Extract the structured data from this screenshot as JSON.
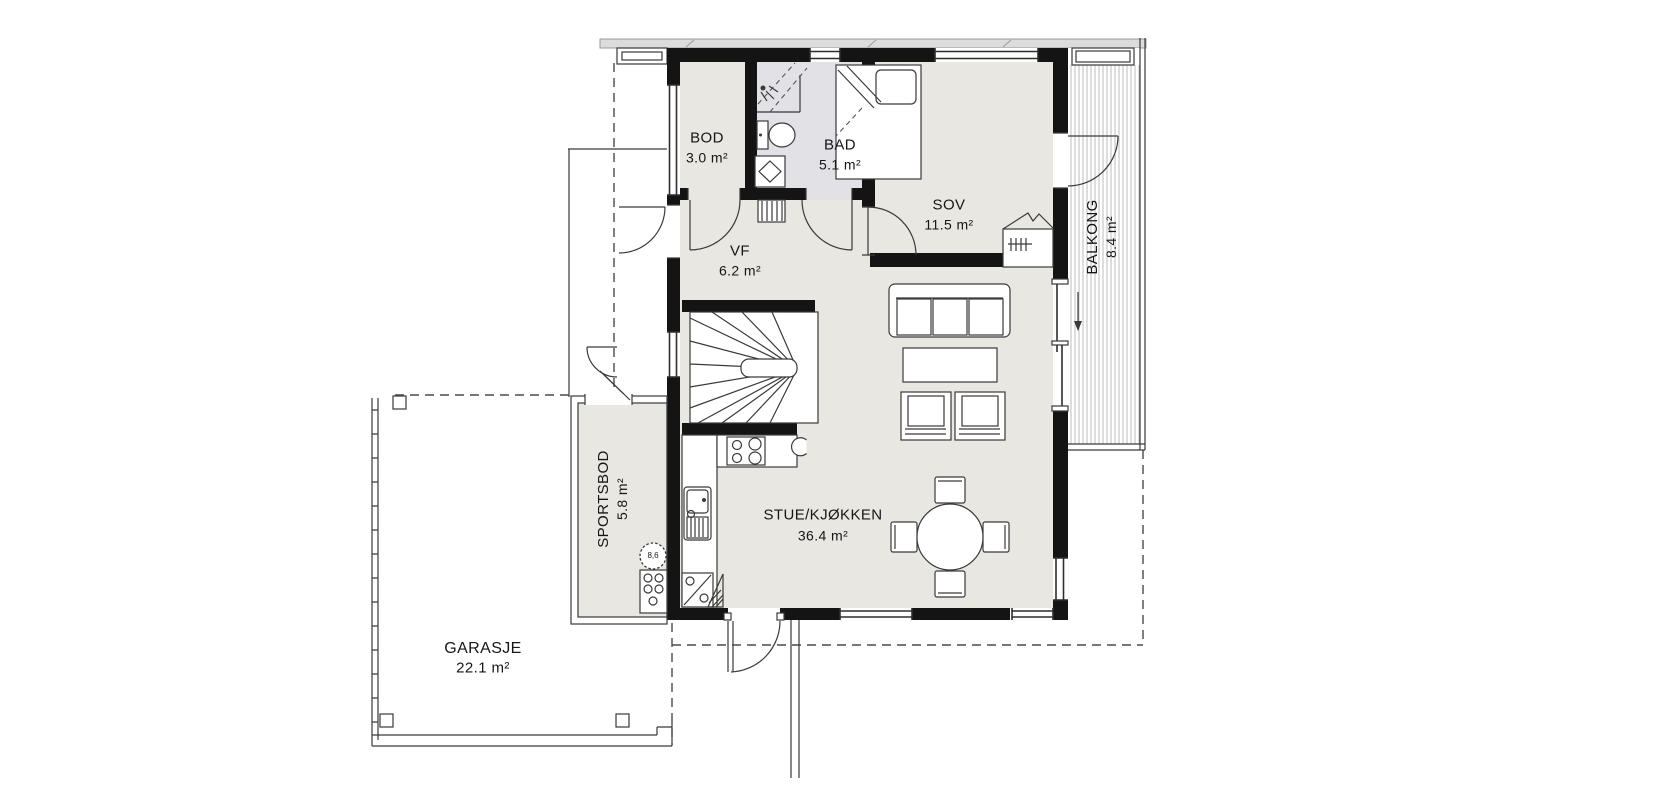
{
  "colors": {
    "wall": "#141414",
    "floor": "#e9e7e1",
    "bad_floor": "#e2e2e6",
    "line": "#3a3a3a",
    "hatch": "#bdbdbd",
    "text": "#161616"
  },
  "rooms": {
    "bod": {
      "name": "BOD",
      "area": "3.0 m²"
    },
    "bad": {
      "name": "BAD",
      "area": "5.1 m²"
    },
    "sov": {
      "name": "SOV",
      "area": "11.5 m²"
    },
    "vf": {
      "name": "VF",
      "area": "6.2 m²"
    },
    "stue": {
      "name": "STUE/KJØKKEN",
      "area": "36.4 m²"
    },
    "balkong": {
      "name": "BALKONG",
      "area": "8.4 m²"
    },
    "sportsbod": {
      "name": "SPORTSBOD",
      "area": "5.8 m²"
    },
    "garasje": {
      "name": "GARASJE",
      "area": "22.1 m²"
    }
  },
  "symbols": {
    "well_label": "8,6",
    "fixtures": [
      "staircase",
      "kitchen-counter",
      "cooktop",
      "kitchen-sink",
      "fridge",
      "dining-table",
      "sofa",
      "coffee-table",
      "armchair",
      "bed",
      "wardrobe",
      "toilet",
      "bathroom-sink",
      "shower",
      "floor-drain",
      "water-heater",
      "balcony-decking",
      "garage-outline",
      "entrance-walkway"
    ]
  }
}
